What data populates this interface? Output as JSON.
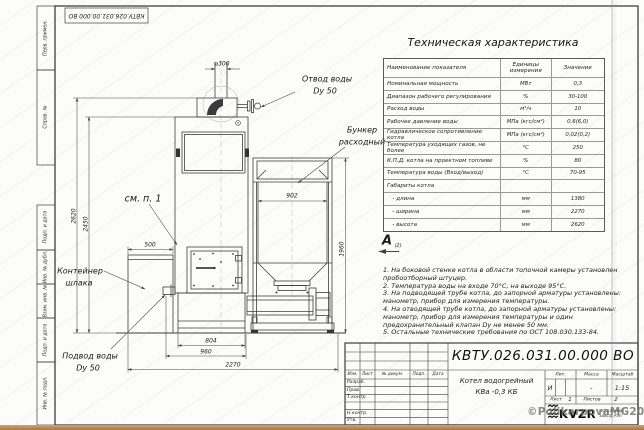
{
  "sheet": {
    "stamp_rotated": "КВТУ.026.031.00.000 ВО",
    "margin_labels_top": [
      "Перв. примен.",
      "Справ. №"
    ],
    "margin_labels_bottom": [
      "Подп. и дата",
      "Инв. № дубл.",
      "Взам. инв. №",
      "Подп. и дата",
      "Инв. № подл."
    ],
    "watermark": "©PolikarpovaMG2021"
  },
  "drawing": {
    "labels": {
      "otvod_line1": "Отвод воды",
      "otvod_line2": "Dy 50",
      "bunker_line1": "Бункер",
      "bunker_line2": "расходный",
      "see_note": "см. п. 1",
      "container_line1": "Контейнер",
      "container_line2": "шлака",
      "podvod_line1": "Подвод воды",
      "podvod_line2": "Dy 50",
      "view_letter": "А",
      "view_ref": "(2)"
    },
    "dims": {
      "chimney_dia": "⌀300",
      "bunker_width": "902",
      "bunker_height": "1960",
      "total_height": "2620",
      "boiler_height": "2450",
      "container_width": "500",
      "boiler_base": "804",
      "boiler_width": "960",
      "total_length": "2270"
    }
  },
  "tech_table": {
    "title": "Техническая характеристика",
    "headers": [
      "Наименование показателя",
      "Единицы измерения",
      "Значение"
    ],
    "rows": [
      {
        "name": "Номинальная мощность",
        "unit": "МВт",
        "value": "0,3"
      },
      {
        "name": "Диапазон рабочего регулирования",
        "unit": "%",
        "value": "30-100"
      },
      {
        "name": "Расход воды",
        "unit": "м³/ч",
        "value": "10"
      },
      {
        "name": "Рабочее давление воды",
        "unit": "МПа (кгс/см²)",
        "value": "0,6(6,0)"
      },
      {
        "name": "Гидравлическое сопротивление котла",
        "unit": "МПа (кгс/см²)",
        "value": "0,02(0,2)"
      },
      {
        "name": "Температура уходящих газов, не более",
        "unit": "°С",
        "value": "250"
      },
      {
        "name": "К.П.Д. котла на проектном топливе",
        "unit": "%",
        "value": "80"
      },
      {
        "name": "Температура воды (Вход/выход)",
        "unit": "°С",
        "value": "70-95"
      },
      {
        "name": "Габариты котла",
        "unit": "",
        "value": ""
      },
      {
        "name": "   - длина",
        "unit": "мм",
        "value": "1380"
      },
      {
        "name": "   - ширина",
        "unit": "мм",
        "value": "2270"
      },
      {
        "name": "   - высота",
        "unit": "мм",
        "value": "2620"
      }
    ]
  },
  "notes": [
    "1. На боковой стенке котла в области топочной камеры установлен пробоотборный штуцер.",
    "2. Температура воды на входе 70°С, на выходе 95°С.",
    "3. На подводящей трубе котла, до запорной арматуры установлены: манометр, прибор для измерения температуры.",
    "4. На отводящей трубе котла, до запорной арматуры установлены: манометр, прибор для измерения температуры и один предохранительный клапан Dy не менее 50 мм.",
    "5. Остальные технические требования по ОСТ 108.030.133-84."
  ],
  "title_block": {
    "doc_number": "КВТУ.026.031.00.000 ВО",
    "col_headers": [
      "Изм.",
      "Лист",
      "№ докум.",
      "Подп.",
      "Дата"
    ],
    "row_labels": [
      "Разраб.",
      "Пров.",
      "Т.контр.",
      "",
      "Н.контр.",
      "Утв."
    ],
    "product_line1": "Котел водогрейный",
    "product_line2": "КВа -0,3 КБ",
    "lit_header": "Лит.",
    "mass_header": "Масса",
    "scale_header": "Масштаб",
    "lit_value": "И",
    "mass_value": "-",
    "scale_value": "1:15",
    "sheet_label": "Лист",
    "sheet_value": "1",
    "sheets_label": "Листов",
    "sheets_value": "2",
    "company_name": "KVZR",
    "company_line1": "КОТЕЛЬНЫЙ",
    "company_line2": "ЗАВОД РЭП"
  }
}
